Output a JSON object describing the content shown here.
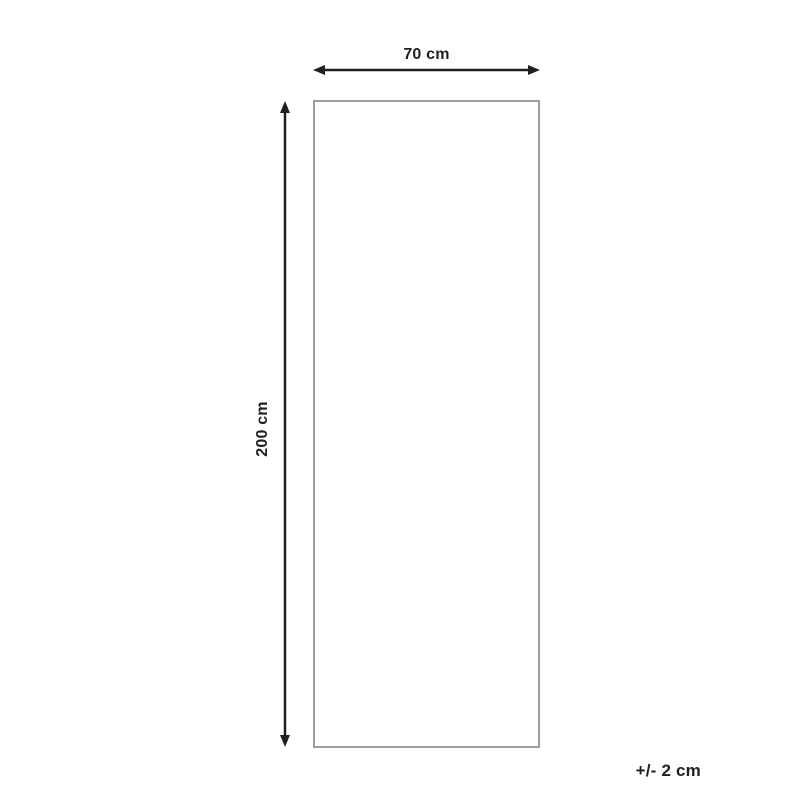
{
  "diagram": {
    "type": "product-dimension-diagram",
    "width_label": "70 cm",
    "height_label": "200 cm",
    "tolerance_label": "+/- 2 cm",
    "width_value_cm": 70,
    "height_value_cm": 200,
    "tolerance_value_cm": 2,
    "colors": {
      "arrow": "#231f20",
      "text": "#231f20",
      "outline": "#9d9d9c",
      "background": "#ffffff"
    }
  }
}
